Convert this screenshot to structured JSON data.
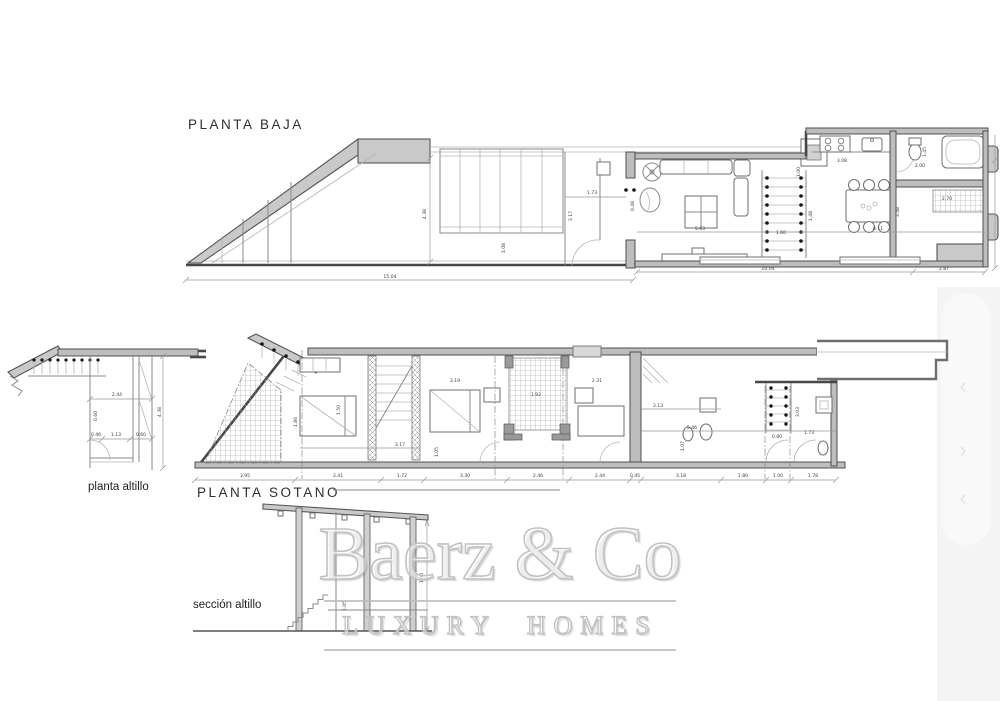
{
  "watermark": {
    "brand": "Baerz & Co",
    "tagline": "LUXURY HOMES"
  },
  "gallery": {
    "prev_icon": "‹",
    "next_icon": "›",
    "panel_color": "#f4f4f5",
    "pill_color": "#f9f9fa"
  },
  "plan_baja": {
    "title": "PLANTA BAJA",
    "dim_total": "15.04",
    "dim_right_main": "10.04",
    "dim_right_ext": "2.87",
    "dim_height": "4.38",
    "dim_glazing": "1.08",
    "dim_entry_width": "1.73",
    "dim_entry_depth": "3.17",
    "dim_door": "0.48",
    "dim_living_width": "5.63",
    "dim_kitchen_width": "3.08",
    "dim_kitchen_depth": "1.00",
    "dim_wc": "1.45",
    "dim_hall": "2.00",
    "dim_stair_width": "1.60",
    "dim_stair_run": "1.48",
    "dim_dining_width": "8.11",
    "dim_dining_height": "3.48",
    "dim_bath_stairs": "2.70"
  },
  "plan_sotano": {
    "title": "PLANTA SOTANO",
    "dims_bottom": [
      "3.95",
      "3.41",
      "1.72",
      "3.30",
      "2.46",
      "2.44",
      "0.45",
      "3.18",
      "1.80",
      "1.00",
      "1.78"
    ],
    "dim_bed_width": "3.17",
    "dim_pass": "1.05",
    "dim_room_depth": "1.50",
    "dim_patio": "1.92",
    "dim_hall_top": "2.31",
    "dim_corridor": "3.19",
    "dim_bath_width": "3.13",
    "dim_right_width": "5.46",
    "dim_right_depth": "1.07",
    "dim_stair_width": "0.80",
    "dim_stair_depth": "3.03",
    "dim_wc": "1.73",
    "dim_left_depth": "1.86"
  },
  "plan_altillo": {
    "title": "planta altillo",
    "dim_width": "2.44",
    "dim_a": "0.46",
    "dim_b": "1.13",
    "dim_c": "0.60",
    "dim_side": "0.60",
    "dim_height": "4.38"
  },
  "seccion": {
    "title": "sección altillo",
    "dim_height": "1.90",
    "dim_small": "1.05"
  }
}
